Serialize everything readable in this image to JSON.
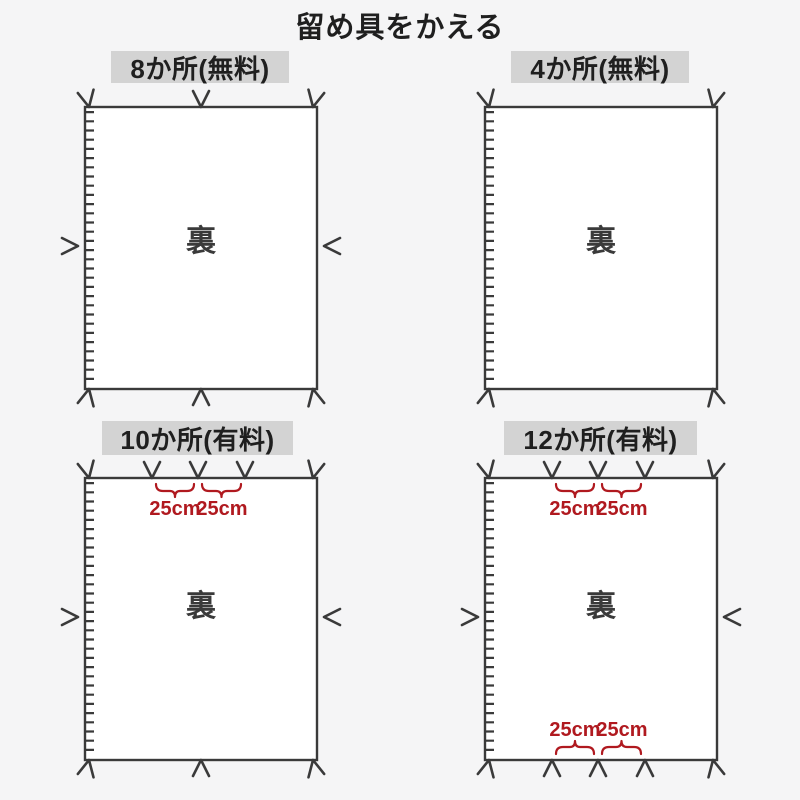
{
  "title": "留め具をかえる",
  "colors": {
    "background": "#f5f5f6",
    "sheet": "#ffffff",
    "line": "#3a3a3a",
    "header_bg": "#d3d3d3",
    "text": "#1f1f1f",
    "accent_red": "#b0191f"
  },
  "panels": [
    {
      "label": "8か所(無料)",
      "fastener_count": 8,
      "back_label": "裏",
      "fastener_layout": {
        "top": 3,
        "bottom": 3,
        "left": 1,
        "right": 1
      },
      "zipper_edge": "left",
      "measurements": []
    },
    {
      "label": "4か所(無料)",
      "fastener_count": 4,
      "back_label": "裏",
      "fastener_layout": {
        "top": 2,
        "bottom": 2,
        "left": 0,
        "right": 0
      },
      "zipper_edge": "left",
      "measurements": []
    },
    {
      "label": "10か所(有料)",
      "fastener_count": 10,
      "back_label": "裏",
      "fastener_layout": {
        "top": 5,
        "bottom": 3,
        "left": 1,
        "right": 1
      },
      "zipper_edge": "left",
      "measurements": [
        {
          "position": "top",
          "label": "25cm"
        },
        {
          "position": "top",
          "label": "25cm"
        }
      ]
    },
    {
      "label": "12か所(有料)",
      "fastener_count": 12,
      "back_label": "裏",
      "fastener_layout": {
        "top": 5,
        "bottom": 5,
        "left": 1,
        "right": 1
      },
      "zipper_edge": "left",
      "measurements": [
        {
          "position": "top",
          "label": "25cm"
        },
        {
          "position": "top",
          "label": "25cm"
        },
        {
          "position": "bottom",
          "label": "25cm"
        },
        {
          "position": "bottom",
          "label": "25cm"
        }
      ]
    }
  ]
}
